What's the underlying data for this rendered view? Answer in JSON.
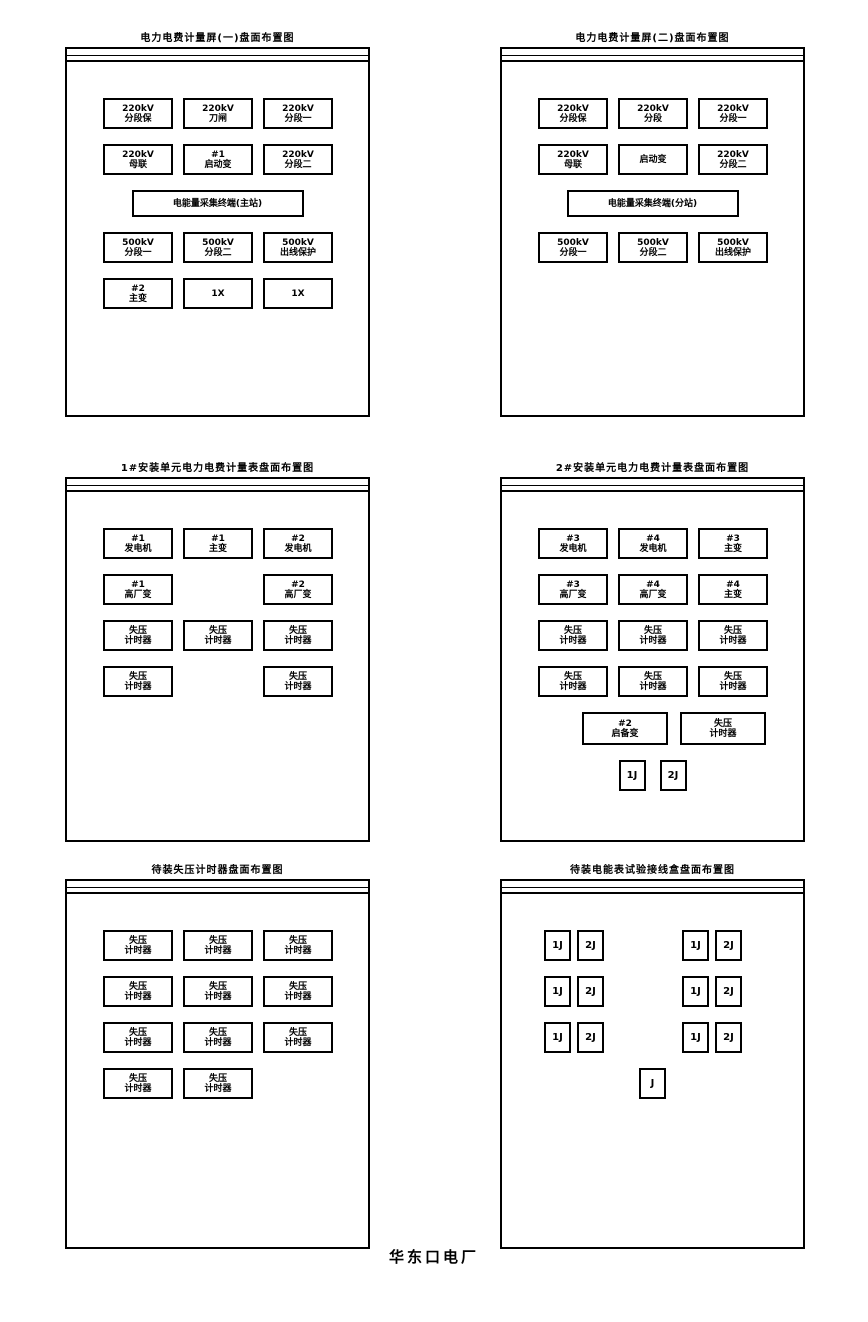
{
  "page": {
    "factory_label": "华东口电厂"
  },
  "panels": [
    {
      "title": "电力电费计量屏(一)盘面布置图",
      "rows": [
        {
          "align": "left",
          "boxes": [
            {
              "kind": "std",
              "lines": [
                "220kV",
                "分段保"
              ]
            },
            {
              "kind": "std",
              "lines": [
                "220kV",
                "刀闸"
              ]
            },
            {
              "kind": "std",
              "lines": [
                "220kV",
                "分段一"
              ]
            }
          ]
        },
        {
          "align": "left",
          "boxes": [
            {
              "kind": "std",
              "lines": [
                "220kV",
                "母联"
              ]
            },
            {
              "kind": "std",
              "lines": [
                "#1",
                "启动变"
              ]
            },
            {
              "kind": "std",
              "lines": [
                "220kV",
                "分段二"
              ]
            }
          ]
        },
        {
          "align": "center",
          "boxes": [
            {
              "kind": "wide",
              "lines": [
                "电能量采集终端(主站)"
              ]
            }
          ]
        },
        {
          "align": "left",
          "boxes": [
            {
              "kind": "std",
              "lines": [
                "500kV",
                "分段一"
              ]
            },
            {
              "kind": "std",
              "lines": [
                "500kV",
                "分段二"
              ]
            },
            {
              "kind": "std",
              "lines": [
                "500kV",
                "出线保护"
              ]
            }
          ]
        },
        {
          "align": "left",
          "boxes": [
            {
              "kind": "std",
              "lines": [
                "#2",
                "主变"
              ]
            },
            {
              "kind": "std",
              "lines": [
                "1X"
              ]
            },
            {
              "kind": "std",
              "lines": [
                "1X"
              ]
            }
          ]
        }
      ]
    },
    {
      "title": "电力电费计量屏(二)盘面布置图",
      "rows": [
        {
          "align": "left",
          "boxes": [
            {
              "kind": "std",
              "lines": [
                "220kV",
                "分段保"
              ]
            },
            {
              "kind": "std",
              "lines": [
                "220kV",
                "分段"
              ]
            },
            {
              "kind": "std",
              "lines": [
                "220kV",
                "分段一"
              ]
            }
          ]
        },
        {
          "align": "left",
          "boxes": [
            {
              "kind": "std",
              "lines": [
                "220kV",
                "母联"
              ]
            },
            {
              "kind": "std",
              "lines": [
                "启动变"
              ]
            },
            {
              "kind": "std",
              "lines": [
                "220kV",
                "分段二"
              ]
            }
          ]
        },
        {
          "align": "center",
          "boxes": [
            {
              "kind": "wide",
              "lines": [
                "电能量采集终端(分站)"
              ]
            }
          ]
        },
        {
          "align": "left",
          "boxes": [
            {
              "kind": "std",
              "lines": [
                "500kV",
                "分段一"
              ]
            },
            {
              "kind": "std",
              "lines": [
                "500kV",
                "分段二"
              ]
            },
            {
              "kind": "std",
              "lines": [
                "500kV",
                "出线保护"
              ]
            }
          ]
        }
      ]
    },
    {
      "title": "1#安装单元电力电费计量表盘面布置图",
      "rows": [
        {
          "align": "left",
          "boxes": [
            {
              "kind": "std",
              "lines": [
                "#1",
                "发电机"
              ]
            },
            {
              "kind": "std",
              "lines": [
                "#1",
                "主变"
              ]
            },
            {
              "kind": "std",
              "lines": [
                "#2",
                "发电机"
              ]
            }
          ]
        },
        {
          "align": "left",
          "boxes": [
            {
              "kind": "std",
              "lines": [
                "#1",
                "高厂变"
              ]
            },
            {
              "kind": "ghost"
            },
            {
              "kind": "std",
              "lines": [
                "#2",
                "高厂变"
              ]
            }
          ]
        },
        {
          "align": "left",
          "boxes": [
            {
              "kind": "std",
              "lines": [
                "失压",
                "计时器"
              ]
            },
            {
              "kind": "std",
              "lines": [
                "失压",
                "计时器"
              ]
            },
            {
              "kind": "std",
              "lines": [
                "失压",
                "计时器"
              ]
            }
          ]
        },
        {
          "align": "left",
          "boxes": [
            {
              "kind": "std",
              "lines": [
                "失压",
                "计时器"
              ]
            },
            {
              "kind": "ghost"
            },
            {
              "kind": "std",
              "lines": [
                "失压",
                "计时器"
              ]
            }
          ]
        }
      ]
    },
    {
      "title": "2#安装单元电力电费计量表盘面布置图",
      "rows": [
        {
          "align": "left",
          "boxes": [
            {
              "kind": "std",
              "lines": [
                "#3",
                "发电机"
              ]
            },
            {
              "kind": "std",
              "lines": [
                "#4",
                "发电机"
              ]
            },
            {
              "kind": "std",
              "lines": [
                "#3",
                "主变"
              ]
            }
          ]
        },
        {
          "align": "left",
          "boxes": [
            {
              "kind": "std",
              "lines": [
                "#3",
                "高厂变"
              ]
            },
            {
              "kind": "std",
              "lines": [
                "#4",
                "高厂变"
              ]
            },
            {
              "kind": "std",
              "lines": [
                "#4",
                "主变"
              ]
            }
          ]
        },
        {
          "align": "left",
          "boxes": [
            {
              "kind": "std",
              "lines": [
                "失压",
                "计时器"
              ]
            },
            {
              "kind": "std",
              "lines": [
                "失压",
                "计时器"
              ]
            },
            {
              "kind": "std",
              "lines": [
                "失压",
                "计时器"
              ]
            }
          ]
        },
        {
          "align": "left",
          "boxes": [
            {
              "kind": "std",
              "lines": [
                "失压",
                "计时器"
              ]
            },
            {
              "kind": "std",
              "lines": [
                "失压",
                "计时器"
              ]
            },
            {
              "kind": "std",
              "lines": [
                "失压",
                "计时器"
              ]
            }
          ]
        },
        {
          "align": "center2",
          "boxes": [
            {
              "kind": "med",
              "lines": [
                "#2",
                "启备变"
              ]
            },
            {
              "kind": "med",
              "lines": [
                "失压",
                "计时器"
              ]
            }
          ]
        },
        {
          "align": "centersm",
          "boxes": [
            {
              "kind": "small",
              "lines": [
                "1J"
              ]
            },
            {
              "kind": "small",
              "lines": [
                "2J"
              ]
            }
          ]
        }
      ]
    },
    {
      "title": "待装失压计时器盘面布置图",
      "rows": [
        {
          "align": "left",
          "boxes": [
            {
              "kind": "std",
              "lines": [
                "失压",
                "计时器"
              ]
            },
            {
              "kind": "std",
              "lines": [
                "失压",
                "计时器"
              ]
            },
            {
              "kind": "std",
              "lines": [
                "失压",
                "计时器"
              ]
            }
          ]
        },
        {
          "align": "left",
          "boxes": [
            {
              "kind": "std",
              "lines": [
                "失压",
                "计时器"
              ]
            },
            {
              "kind": "std",
              "lines": [
                "失压",
                "计时器"
              ]
            },
            {
              "kind": "std",
              "lines": [
                "失压",
                "计时器"
              ]
            }
          ]
        },
        {
          "align": "left",
          "boxes": [
            {
              "kind": "std",
              "lines": [
                "失压",
                "计时器"
              ]
            },
            {
              "kind": "std",
              "lines": [
                "失压",
                "计时器"
              ]
            },
            {
              "kind": "std",
              "lines": [
                "失压",
                "计时器"
              ]
            }
          ]
        },
        {
          "align": "left",
          "boxes": [
            {
              "kind": "std",
              "lines": [
                "失压",
                "计时器"
              ]
            },
            {
              "kind": "std",
              "lines": [
                "失压",
                "计时器"
              ]
            }
          ]
        }
      ]
    },
    {
      "title": "待装电能表试验接线盒盘面布置图",
      "rows": [
        {
          "align": "pairs",
          "boxes": [
            {
              "kind": "small",
              "lines": [
                "1J"
              ]
            },
            {
              "kind": "small",
              "lines": [
                "2J"
              ]
            },
            {
              "kind": "gap"
            },
            {
              "kind": "small",
              "lines": [
                "1J"
              ]
            },
            {
              "kind": "small",
              "lines": [
                "2J"
              ]
            }
          ]
        },
        {
          "align": "pairs",
          "boxes": [
            {
              "kind": "small",
              "lines": [
                "1J"
              ]
            },
            {
              "kind": "small",
              "lines": [
                "2J"
              ]
            },
            {
              "kind": "gap"
            },
            {
              "kind": "small",
              "lines": [
                "1J"
              ]
            },
            {
              "kind": "small",
              "lines": [
                "2J"
              ]
            }
          ]
        },
        {
          "align": "pairs",
          "boxes": [
            {
              "kind": "small",
              "lines": [
                "1J"
              ]
            },
            {
              "kind": "small",
              "lines": [
                "2J"
              ]
            },
            {
              "kind": "gap"
            },
            {
              "kind": "small",
              "lines": [
                "1J"
              ]
            },
            {
              "kind": "small",
              "lines": [
                "2J"
              ]
            }
          ]
        },
        {
          "align": "centersm",
          "boxes": [
            {
              "kind": "small",
              "lines": [
                "J"
              ]
            }
          ]
        }
      ]
    }
  ]
}
